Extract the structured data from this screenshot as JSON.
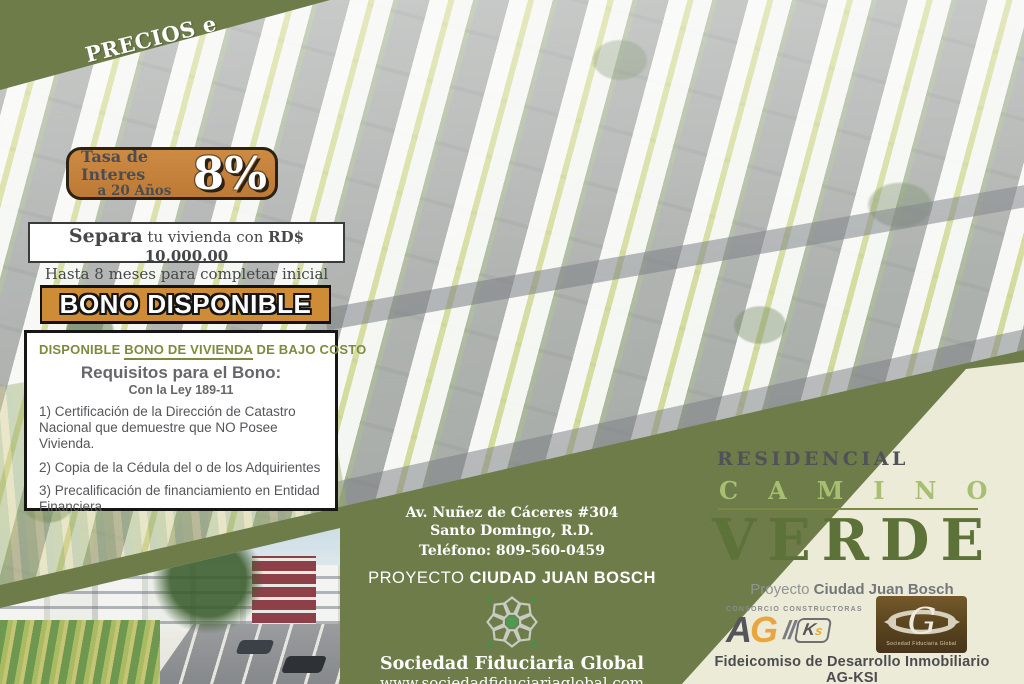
{
  "colors": {
    "olive": "#6d7c49",
    "cream": "#ecebd8",
    "badge_orange": "#c8833e",
    "banner_orange": "#cf8c36",
    "camino_green": "#a8bf72",
    "verde_green": "#5c7239"
  },
  "ribbon": {
    "label": "PRECIOS e INFORMACIONES"
  },
  "rate_badge": {
    "title": "Tasa de Interes",
    "subtitle": "a 20 Años",
    "value": "8%"
  },
  "reserve": {
    "lead": "Separa",
    "mid": " tu vivienda con ",
    "amount": "RD$ 10,000.00",
    "line2": "Hasta 8 meses para completar inicial"
  },
  "bono": {
    "banner": "BONO DISPONIBLE",
    "line_pre": "DISPONIBLE ",
    "line_underlined": "BONO DE VIVIENDA",
    "line_post": " DE BAJO COSTO",
    "req_title": "Requisitos para el Bono:",
    "req_law": "Con la Ley 189-11",
    "items": [
      "1) Certificación de la Dirección de Catastro Nacional que demuestre que NO Posee Vivienda.",
      "2) Copia de la Cédula del o de los Adquirientes",
      "3) Precalificación de financiamiento en Entidad Financiera"
    ]
  },
  "contact": {
    "address1": "Av. Nuñez de Cáceres #304",
    "address2": "Santo Domingo, R.D.",
    "phone": "Teléfono: 809-560-0459",
    "project_prefix": "PROYECTO ",
    "project_name": "CIUDAD JUAN BOSCH",
    "company": "Sociedad Fiduciaria Global",
    "website": "www.sociedadfiduciariaglobal.com"
  },
  "brand": {
    "residencial": "RESIDENCIAL",
    "camino": "CAMINO",
    "verde": "VERDE",
    "proyecto_prefix": "Proyecto ",
    "proyecto_name": "Ciudad Juan Bosch",
    "consorcio": "CONSORCIO CONSTRUCTORAS",
    "ag_a": "A",
    "ag_g": "G",
    "ag_slash": "//",
    "ks_k": "K",
    "ks_s": "s",
    "g_letter": "G",
    "g_label": "Sociedad Fiduciaria Global",
    "fideicomiso": "Fideicomiso de Desarrollo Inmobiliario AG-KSI"
  }
}
